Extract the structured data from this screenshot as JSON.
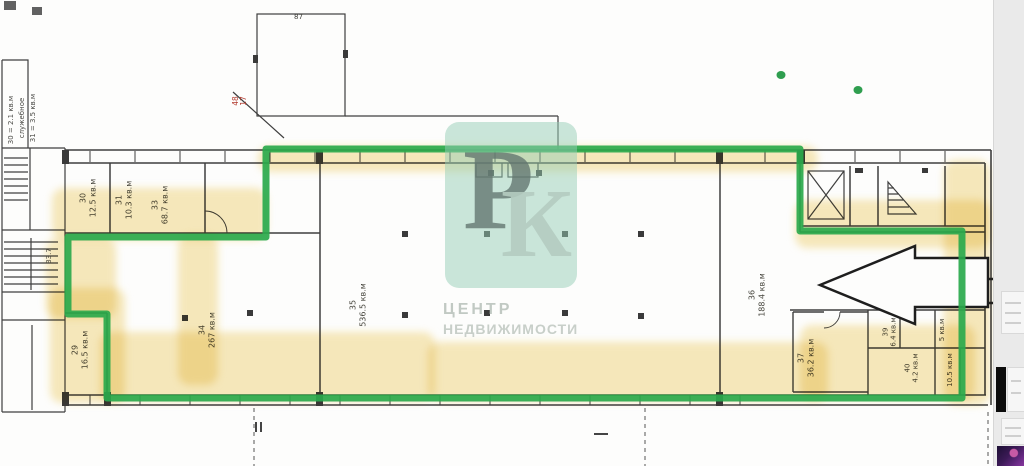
{
  "watermark": {
    "letter_p": "Р",
    "letter_k": "К",
    "line1": "ЦЕНТР",
    "line2": "НЕДВИЖИМОСТИ"
  },
  "plan": {
    "rooms": [
      {
        "number": "29",
        "area": "16.5 кв.м"
      },
      {
        "number": "30",
        "area": "12.5 кв.м"
      },
      {
        "number": "31",
        "area": "10.3 кв.м"
      },
      {
        "number": "33",
        "area": "68.7 кв.м"
      },
      {
        "number": "34",
        "area": "267 кв.м"
      },
      {
        "number": "35",
        "area": "536.5 кв.м"
      },
      {
        "number": "36",
        "area": "188.4 кв.м"
      },
      {
        "number": "37",
        "area": "36.2 кв.м"
      },
      {
        "number": "39",
        "area": "6.4 кв.м"
      },
      {
        "number": "40",
        "area": "4.2 кв.м"
      },
      {
        "number": "",
        "area": "5 кв.м"
      },
      {
        "number": "",
        "area": "10.5 кв.м"
      }
    ],
    "margin_notes": [
      "30 = 2.1 кв.м",
      "служебное",
      "31 = 3.5 кв.м"
    ],
    "stair_note": "33.7",
    "red_note_top": "48",
    "red_note_bottom": "17",
    "annex_note": "87"
  },
  "colors": {
    "highlight_yellow": "#efd37a",
    "outline_green": "#2aa94c",
    "watermark_teal": "#96ceb6",
    "plan_line": "#3f3f3f",
    "arrow_stroke": "#1e1e1e"
  }
}
